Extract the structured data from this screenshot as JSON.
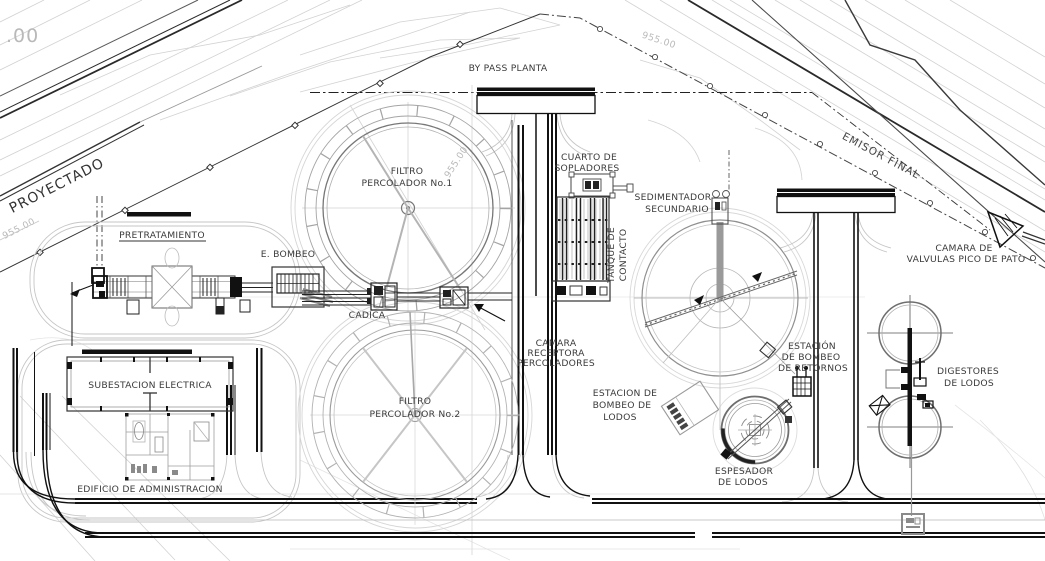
{
  "drawing": {
    "type": "site-plan",
    "plant": "planta de tratamiento de aguas residuales",
    "colors": {
      "background": "#ffffff",
      "line_dark": "#1a1a1a",
      "line_mid": "#8a8a8a",
      "line_light": "#c8c8c8",
      "label_text": "#3a3a3a",
      "elevation_text": "#b9b9b9"
    },
    "labels": {
      "proyectado": "PROYECTADO",
      "emisor_final": "EMISOR FINAL",
      "by_pass": "BY PASS PLANTA",
      "filtro1_l1": "FILTRO",
      "filtro1_l2": "PERCOLADOR No.1",
      "filtro2_l1": "FILTRO",
      "filtro2_l2": "PERCOLADOR No.2",
      "cuarto_sopladores_l1": "CUARTO DE",
      "cuarto_sopladores_l2": "SOPLADORES",
      "sedimentador_l1": "SEDIMENTADOR",
      "sedimentador_l2": "SECUNDARIO",
      "pretratamiento": "PRETRATAMIENTO",
      "e_bombeo": "E. BOMBEO",
      "cadica": "CADICA",
      "tanque_contacto_l1": "TANQUE DE",
      "tanque_contacto_l2": "CONTACTO",
      "camara_receptora_l1": "CAMARA",
      "camara_receptora_l2": "RECEPTORA",
      "camara_receptora_l3": "PERCOLADORES",
      "est_bombeo_lodos_l1": "ESTACION DE",
      "est_bombeo_lodos_l2": "BOMBEO DE",
      "est_bombeo_lodos_l3": "LODOS",
      "est_bombeo_retornos_l1": "ESTACIÓN",
      "est_bombeo_retornos_l2": "DE BOMBEO",
      "est_bombeo_retornos_l3": "DE RETORNOS",
      "espesador_l1": "ESPESADOR",
      "espesador_l2": "DE LODOS",
      "digestores_l1": "DIGESTORES",
      "digestores_l2": "DE LODOS",
      "camara_valvulas_l1": "CAMARA DE",
      "camara_valvulas_l2": "VALVULAS PICO DE PATO",
      "subestacion": "SUBESTACION ELECTRICA",
      "edificio_admin": "EDIFICIO DE ADMINISTRACION"
    },
    "elevations": {
      "corner": ".00",
      "contour_top": "955.00",
      "contour_filtro": "955.00",
      "contour_left": "955.00"
    }
  }
}
